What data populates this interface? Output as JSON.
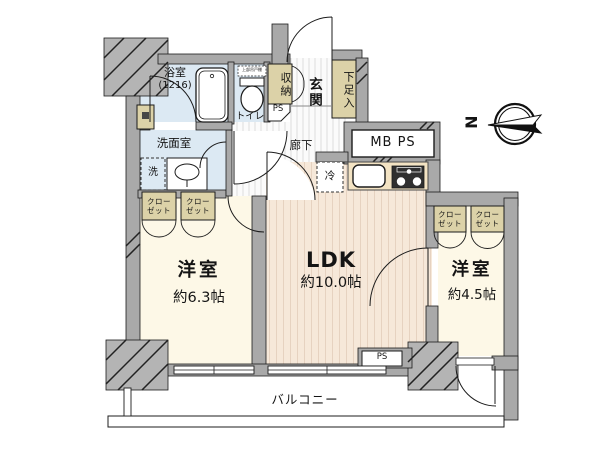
{
  "plan": {
    "compass": "N",
    "balcony": "バルコニー",
    "hallway": "廊下",
    "entrance": "玄関",
    "shoe_cabinet": "下足入",
    "storage": "収納",
    "ps_top": "PS",
    "ps_bottom": "PS",
    "meter_box": "MB PS",
    "bathroom": "浴室",
    "bathroom_size": "(1216)",
    "toilet": "トイレ",
    "toilet_shelf": "上部吊戸棚",
    "washroom": "洗面室",
    "washer": "洗",
    "fridge": "冷",
    "ldk_name": "LDK",
    "ldk_size": "約10.0帖",
    "west_room_name": "洋室",
    "west_room_size": "約6.3帖",
    "east_room_name": "洋室",
    "east_room_size": "約4.5帖",
    "closet_line1": "クロー",
    "closet_line2": "ゼット"
  },
  "colors": {
    "wall": "#a9a9a9",
    "pillar": "#b4b4b4",
    "wet_room_floor": "#dce9f3",
    "bedroom_floor": "#fdf8e7",
    "ldk_floor": "#f6e8d9",
    "ldk_stripe": "#e6d2c0",
    "corridor_stripe": "#dedede",
    "closet": "#dcd2a8",
    "stove": "#2f2f2f",
    "outline": "#1c1c1c"
  }
}
